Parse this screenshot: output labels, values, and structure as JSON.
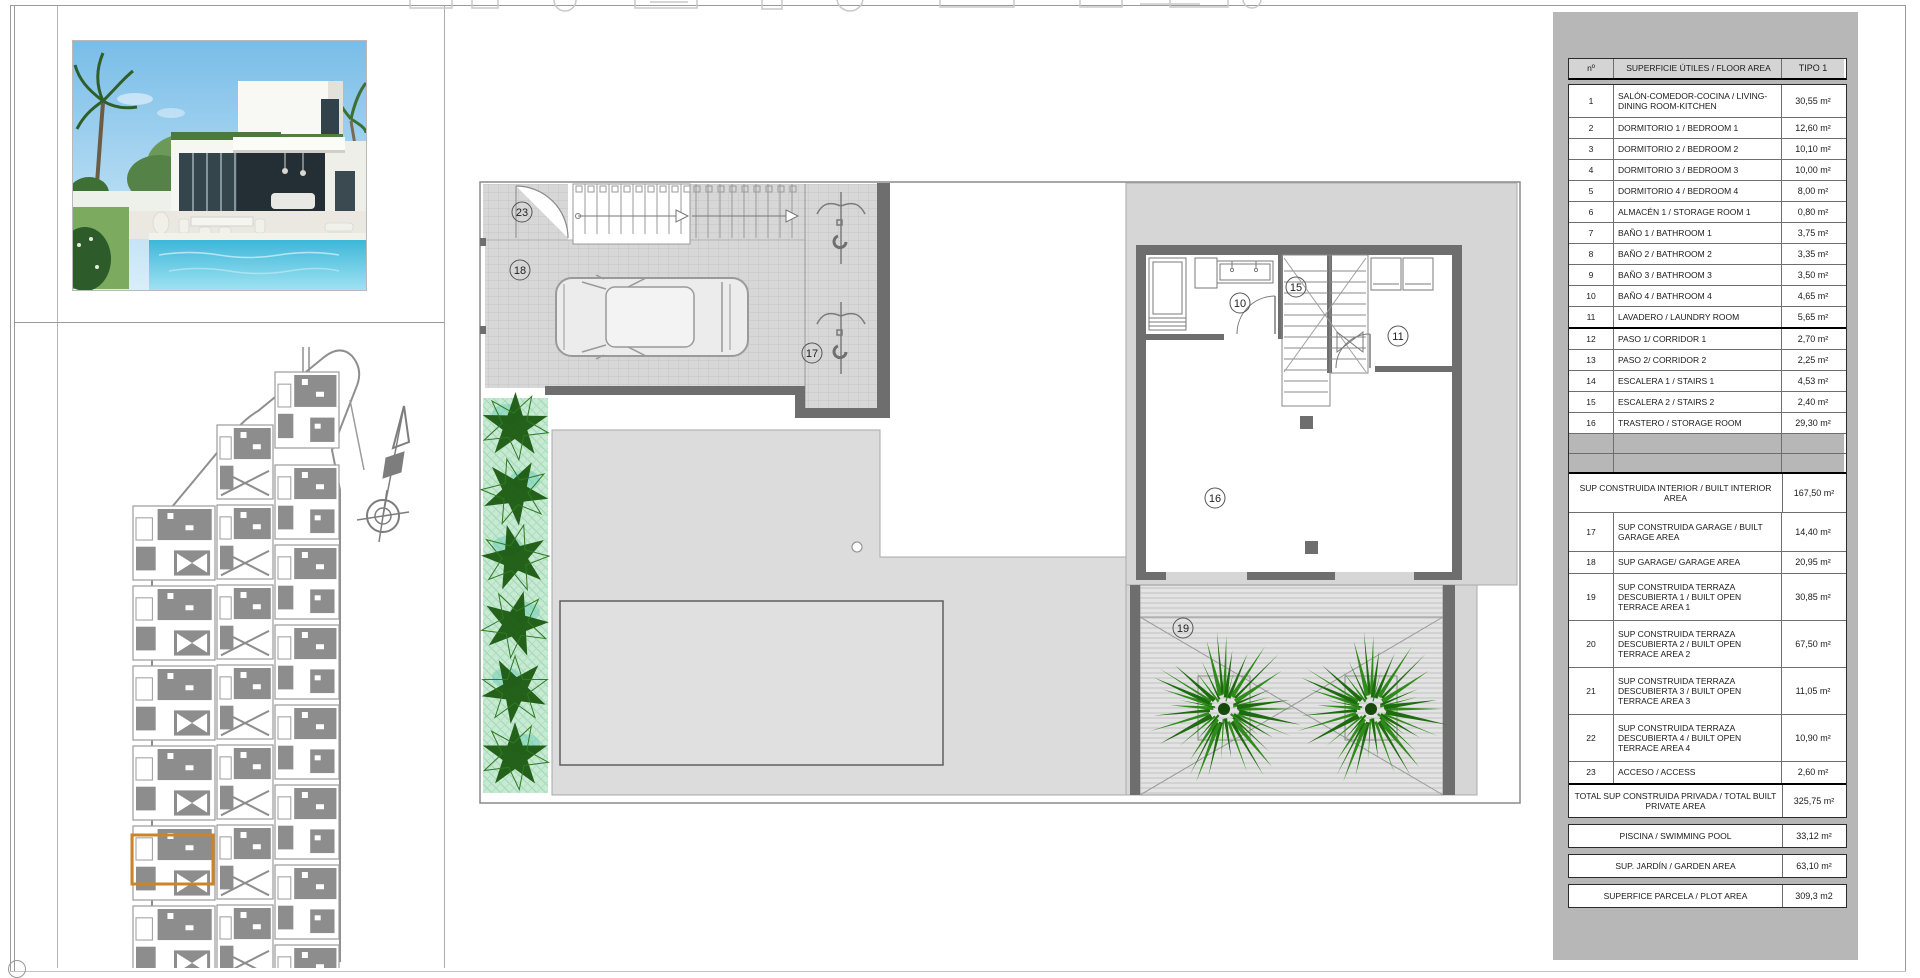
{
  "document": {
    "sheet_type": "floor-plan-sheet",
    "type_label": "TIPO 1"
  },
  "area_table": {
    "headers": {
      "no": "nº",
      "name": "SUPERFICIE ÚTILES / FLOOR AREA",
      "type": "TIPO 1"
    },
    "rooms": [
      {
        "no": "1",
        "label": "SALÓN-COMEDOR-COCINA / LIVING-DINING ROOM-KITCHEN",
        "value": "30,55 m²",
        "lines": 2
      },
      {
        "no": "2",
        "label": "DORMITORIO 1 / BEDROOM 1",
        "value": "12,60 m²",
        "lines": 1
      },
      {
        "no": "3",
        "label": "DORMITORIO 2 / BEDROOM 2",
        "value": "10,10 m²",
        "lines": 1
      },
      {
        "no": "4",
        "label": "DORMITORIO 3 / BEDROOM 3",
        "value": "10,00 m²",
        "lines": 1
      },
      {
        "no": "5",
        "label": "DORMITORIO 4 / BEDROOM 4",
        "value": "8,00 m²",
        "lines": 1
      },
      {
        "no": "6",
        "label": "ALMACÉN 1 / STORAGE ROOM 1",
        "value": "0,80 m²",
        "lines": 1
      },
      {
        "no": "7",
        "label": "BAÑO 1 / BATHROOM 1",
        "value": "3,75 m²",
        "lines": 1
      },
      {
        "no": "8",
        "label": "BAÑO 2 / BATHROOM 2",
        "value": "3,35 m²",
        "lines": 1
      },
      {
        "no": "9",
        "label": "BAÑO 3 / BATHROOM 3",
        "value": "3,50 m²",
        "lines": 1
      },
      {
        "no": "10",
        "label": "BAÑO 4 / BATHROOM 4",
        "value": "4,65 m²",
        "lines": 1
      },
      {
        "no": "11",
        "label": "LAVADERO / LAUNDRY ROOM",
        "value": "5,65 m²",
        "lines": 1
      },
      {
        "no": "12",
        "label": "PASO 1/ CORRIDOR 1",
        "value": "2,70 m²",
        "lines": 1
      },
      {
        "no": "13",
        "label": "PASO 2/ CORRIDOR 2",
        "value": "2,25 m²",
        "lines": 1
      },
      {
        "no": "14",
        "label": "ESCALERA 1 / STAIRS 1",
        "value": "4,53 m²",
        "lines": 1
      },
      {
        "no": "15",
        "label": "ESCALERA 2 / STAIRS 2",
        "value": "2,40 m²",
        "lines": 1
      },
      {
        "no": "16",
        "label": "TRASTERO / STORAGE ROOM",
        "value": "29,30 m²",
        "lines": 1
      }
    ],
    "summary": [
      {
        "no": "",
        "label": "SUP CONSTRUIDA INTERIOR / BUILT INTERIOR AREA",
        "value": "167,50 m²",
        "lines": 2,
        "span": true,
        "thick": true
      },
      {
        "no": "17",
        "label": "SUP CONSTRUIDA GARAGE / BUILT GARAGE AREA",
        "value": "14,40 m²",
        "lines": 2
      },
      {
        "no": "18",
        "label": "SUP GARAGE/ GARAGE AREA",
        "value": "20,95 m²",
        "lines": 1
      },
      {
        "no": "19",
        "label": "SUP CONSTRUIDA TERRAZA DESCUBIERTA 1 / BUILT OPEN TERRACE AREA 1",
        "value": "30,85 m²",
        "lines": 3
      },
      {
        "no": "20",
        "label": "SUP CONSTRUIDA TERRAZA DESCUBIERTA 2 / BUILT OPEN TERRACE AREA 2",
        "value": "67,50 m²",
        "lines": 3
      },
      {
        "no": "21",
        "label": "SUP CONSTRUIDA TERRAZA DESCUBIERTA 3 / BUILT OPEN TERRACE AREA 3",
        "value": "11,05 m²",
        "lines": 3
      },
      {
        "no": "22",
        "label": "SUP CONSTRUIDA TERRAZA DESCUBIERTA 4 / BUILT OPEN TERRACE AREA 4",
        "value": "10,90 m²",
        "lines": 3
      },
      {
        "no": "23",
        "label": "ACCESO / ACCESS",
        "value": "2,60 m²",
        "lines": 1
      },
      {
        "no": "",
        "label": "TOTAL SUP CONSTRUIDA PRIVADA / TOTAL BUILT PRIVATE AREA",
        "value": "325,75 m²",
        "lines": 2,
        "span": true,
        "thick": true
      }
    ],
    "extras": [
      {
        "label": "PISCINA / SWIMMING POOL",
        "value": "33,12 m²"
      },
      {
        "label": "SUP. JARDÍN / GARDEN AREA",
        "value": "63,10 m²"
      },
      {
        "label": "SUPERFICE PARCELA / PLOT AREA",
        "value": "309,3 m2"
      }
    ]
  },
  "floor_plan": {
    "labels": [
      "23",
      "18",
      "17",
      "10",
      "15",
      "11",
      "16",
      "19"
    ]
  },
  "colors": {
    "highlight_orange": "#cd8327",
    "wall_gray": "#6e6e6e",
    "paving_gray": "#dcdcdc",
    "panel_gray": "#b7b7b7",
    "palm_green": "#2f8c1a",
    "palm_green_dark": "#1e6b10",
    "star_green": "#1b5a10"
  }
}
